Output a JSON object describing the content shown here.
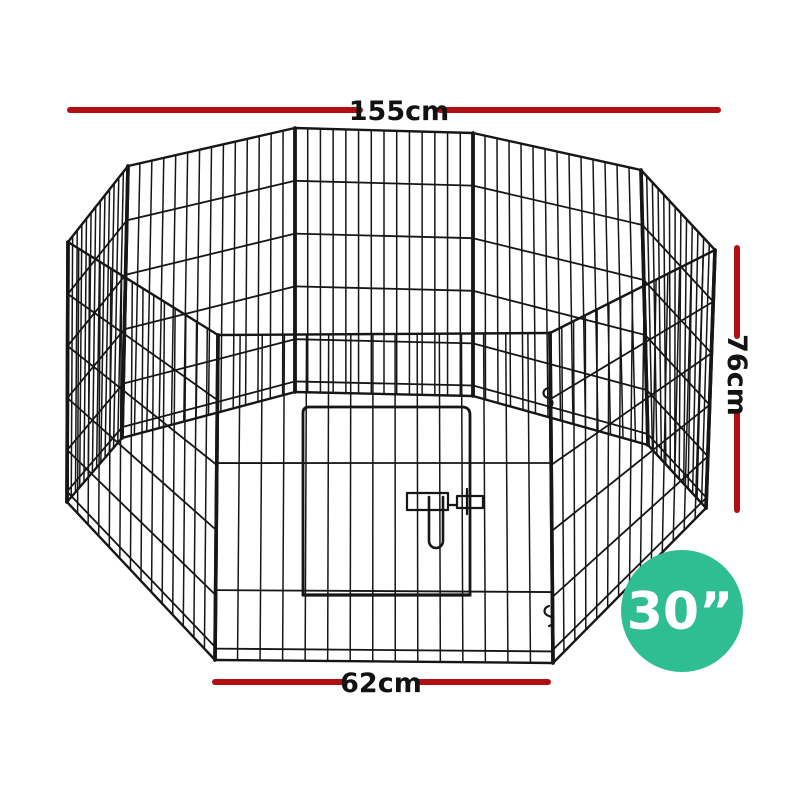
{
  "image": {
    "alt": "8-panel black wire pet playpen with front door",
    "wire_color": "#161616"
  },
  "dimensions": {
    "line_color": "#b00f14",
    "top": {
      "label": "155cm"
    },
    "right": {
      "label": "76cm"
    },
    "bottom": {
      "label": "62cm"
    }
  },
  "badge": {
    "label": "30”",
    "color": "#2fbe92"
  }
}
